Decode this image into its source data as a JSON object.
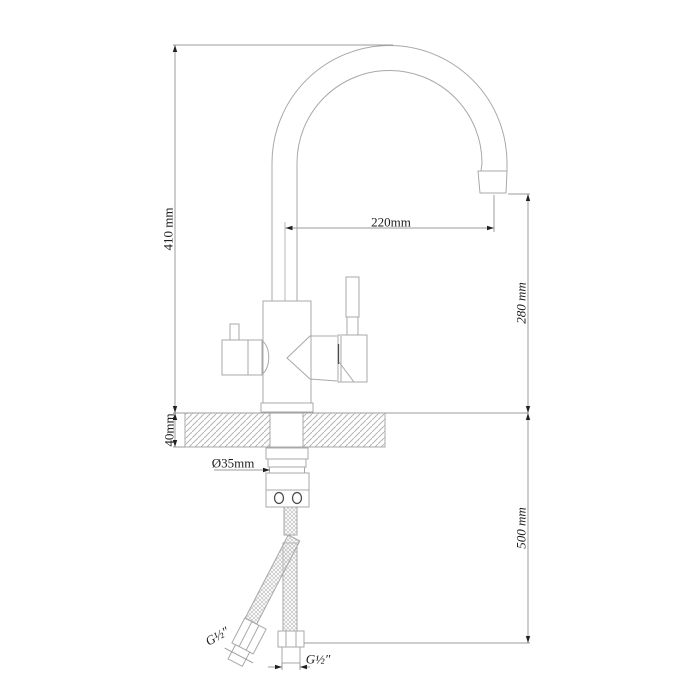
{
  "drawing": {
    "type": "technical-line-drawing",
    "subject": "kitchen faucet side view with gooseneck spout, two handles, deck mounting and supply hoses"
  },
  "dimensions": {
    "total_height": {
      "label": "410 mm"
    },
    "deck_thickness": {
      "label": "40mm"
    },
    "spout_reach": {
      "label": "220mm"
    },
    "spout_height": {
      "label": "280 mm"
    },
    "hose_drop": {
      "label": "500 mm"
    },
    "shank_diameter": {
      "label": "Ø35mm"
    },
    "left_hose_thread": {
      "label": "G½″"
    },
    "bottom_hose_thread": {
      "label": "G½″"
    }
  },
  "colors": {
    "line": "#a8a8a8",
    "dim": "#9b9b9b",
    "arrow": "#222222",
    "accent": "#4a4a4a",
    "text": "#1c1c1c",
    "hatch": "#b5b5b5",
    "braid": "#c2c2c2"
  }
}
